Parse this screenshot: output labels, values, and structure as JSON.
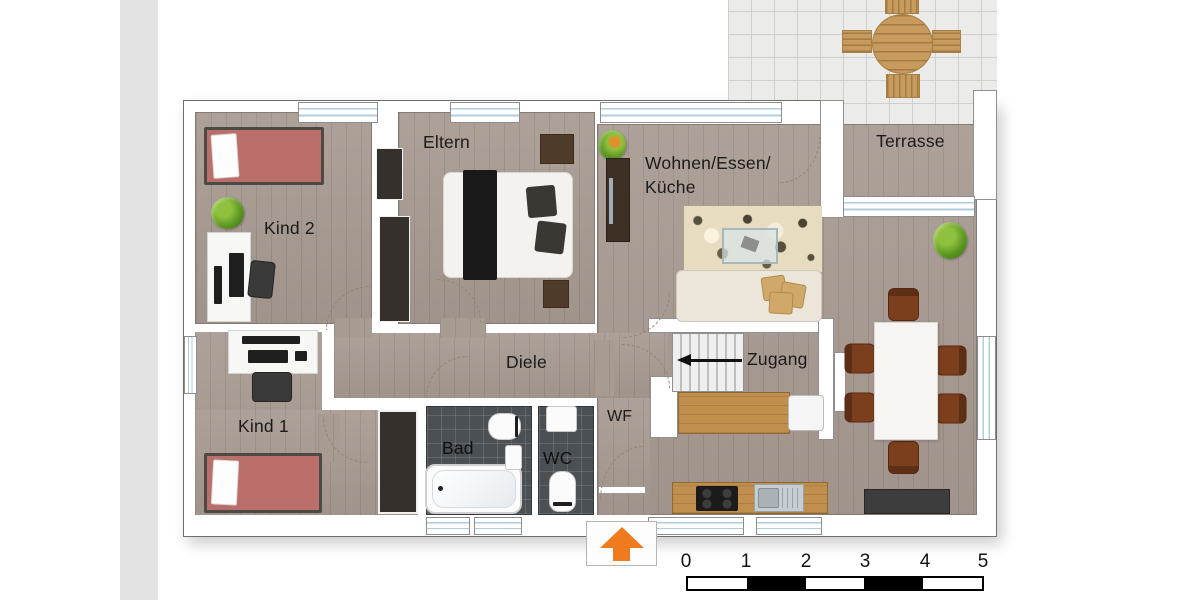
{
  "labels": {
    "kind2": "Kind 2",
    "eltern": "Eltern",
    "wohnen_line1": "Wohnen/Essen/",
    "wohnen_line2": "Küche",
    "terrasse": "Terrasse",
    "kind1": "Kind 1",
    "diele": "Diele",
    "bad": "Bad",
    "wc": "WC",
    "wf": "WF",
    "zugang": "Zugang"
  },
  "scale_bar": {
    "ticks": [
      "0",
      "1",
      "2",
      "3",
      "4",
      "5"
    ],
    "segments": [
      "white",
      "black",
      "white",
      "black",
      "white"
    ]
  },
  "colors": {
    "floor_wood": "#a89b92",
    "bathroom_tile": "#4b5054",
    "terrace_tile": "#ebebe9",
    "bed_pink": "#bb6f6b",
    "entrance_arrow_orange": "#ef7b1e",
    "counter_wood": "#c08f4d",
    "chair_brown": "#7c3f1e",
    "rug_beige": "#e8dcc0",
    "sidebar_strip_gray": "#e3e3e3"
  }
}
